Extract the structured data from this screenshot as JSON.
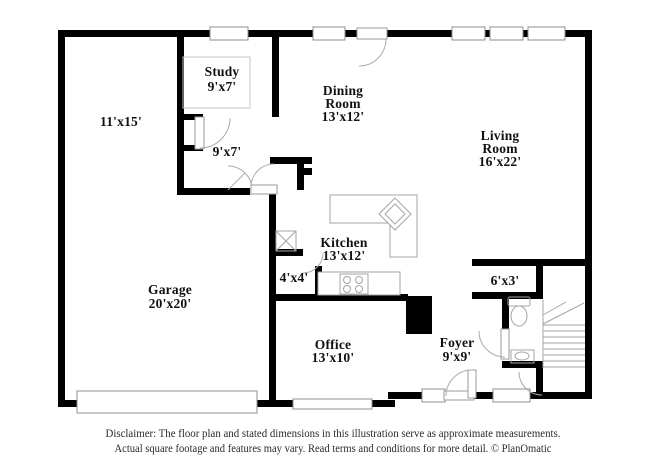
{
  "rooms": {
    "storage": {
      "dims": "11'x15'"
    },
    "study": {
      "name": "Study",
      "dims": "9'x7'"
    },
    "hall": {
      "dims": "9'x7'"
    },
    "dining": {
      "name1": "Dining",
      "name2": "Room",
      "dims": "13'x12'"
    },
    "living": {
      "name1": "Living",
      "name2": "Room",
      "dims": "16'x22'"
    },
    "kitchen": {
      "name": "Kitchen",
      "dims": "13'x12'"
    },
    "closet4x4": {
      "dims": "4'x4'"
    },
    "garage": {
      "name": "Garage",
      "dims": "20'x20'"
    },
    "office": {
      "name": "Office",
      "dims": "13'x10'"
    },
    "foyer": {
      "name": "Foyer",
      "dims": "9'x9'"
    },
    "closet6x3": {
      "dims": "6'x3'"
    }
  },
  "disclaimer": {
    "line1": "Disclaimer: The floor plan and stated dimensions in this illustration serve as approximate measurements.",
    "line2": "Actual square footage and features may vary. Read terms and conditions for more detail. © PlanOmatic"
  },
  "colors": {
    "wall": "#000000",
    "fixture_line": "#a5a5a5",
    "text": "#111111",
    "background": "#ffffff"
  }
}
